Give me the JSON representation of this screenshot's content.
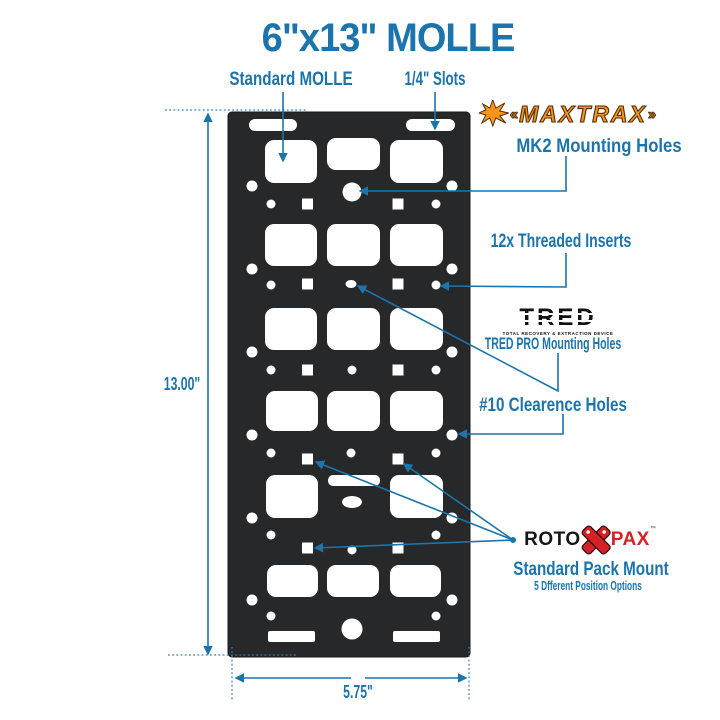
{
  "title": "6\"x13\" MOLLE",
  "callouts": {
    "standard_molle": "Standard MOLLE",
    "quarter_slots": "1/4\" Slots",
    "mk2": "MK2 Mounting Holes",
    "threaded_inserts": "12x Threaded Inserts",
    "tred_pro": "TRED PRO Mounting Holes",
    "clearance": "#10 Clearence Holes",
    "pack_mount": "Standard Pack Mount",
    "pack_positions": "5 Dfferent Position Options"
  },
  "logos": {
    "maxtrax": "MAXTRAX",
    "tred": "TRED",
    "tred_tagline": "TOTAL RECOVERY & EXTRACTION DEVICE",
    "rotopax_left": "ROTO",
    "rotopax_right": "PAX",
    "rotopax_tm": "™"
  },
  "dimensions": {
    "height": "13.00\"",
    "width": "5.75\""
  },
  "colors": {
    "accent_blue": "#1b74ab",
    "panel_black": "#26282a",
    "maxtrax_orange": "#f7941e",
    "rotopax_red": "#d42127"
  }
}
